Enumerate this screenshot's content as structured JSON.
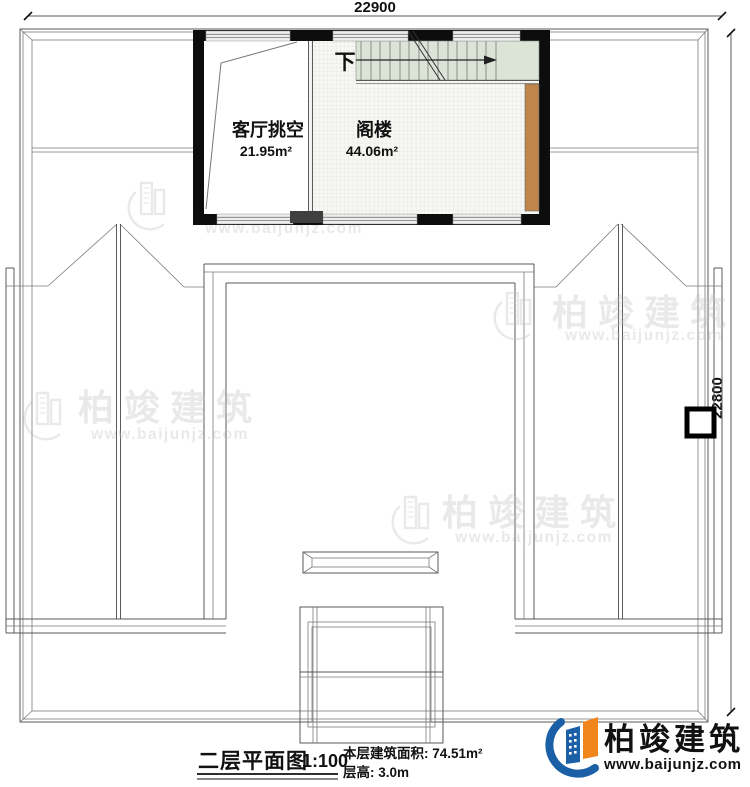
{
  "title_block": {
    "drawing_title": "二层平面图",
    "scale": "1:100",
    "floor_area_label": "本层建筑面积: 74.51m²",
    "floor_height_label": "层高: 3.0m"
  },
  "dimensions": {
    "top_width": "22900",
    "right_height": "22800"
  },
  "rooms": {
    "living_room_void": {
      "name": "客厅挑空",
      "area": "21.95m²"
    },
    "attic": {
      "name": "阁楼",
      "area": "44.06m²"
    }
  },
  "stairs": {
    "direction_label": "下"
  },
  "brand": {
    "name": "柏竣建筑",
    "website": "www.baijunjz.com"
  },
  "watermark": {
    "name": "柏竣建筑",
    "website": "www.baijunjz.com"
  },
  "colors": {
    "stair_green": "#dce4d8",
    "wood_brown": "#c0854a",
    "brand_blue": "#1b5fa6",
    "brand_orange": "#f08519"
  }
}
